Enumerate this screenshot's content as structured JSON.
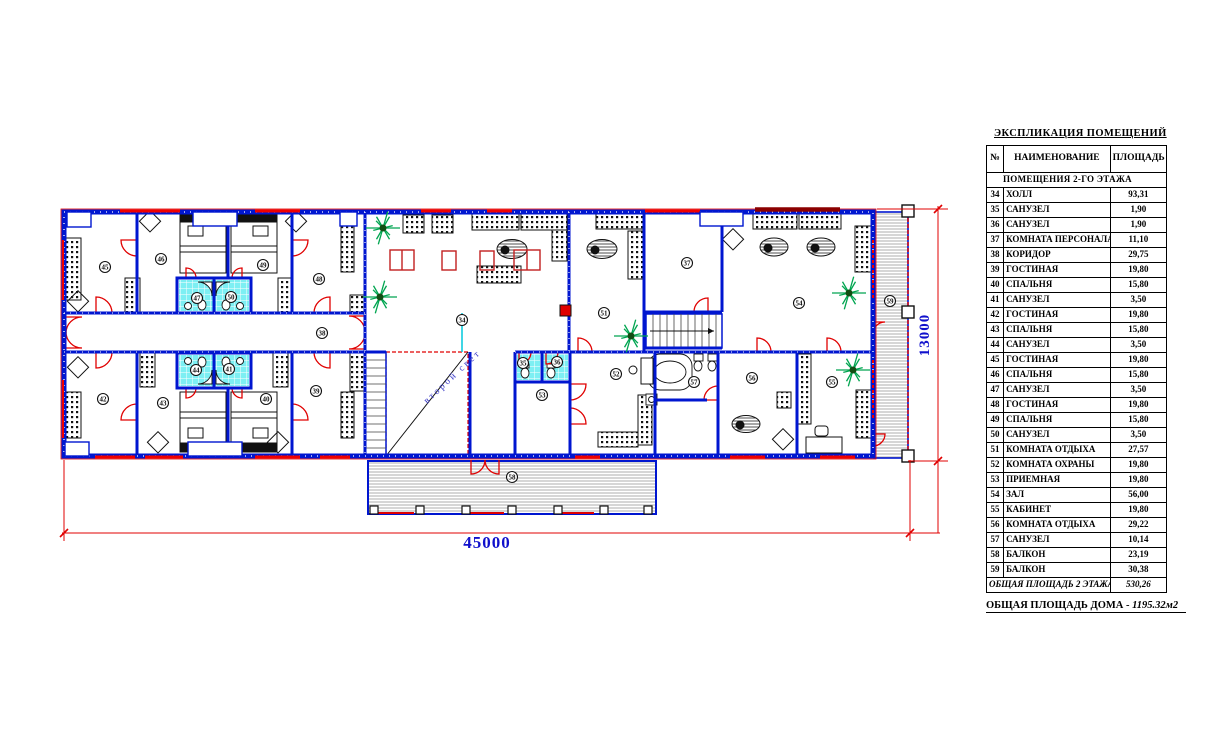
{
  "schedule": {
    "title": "ЭКСПЛИКАЦИЯ ПОМЕЩЕНИЙ",
    "columns": {
      "num": "№",
      "name": "НАИМЕНОВАНИЕ",
      "area": "ПЛОЩАДЬ"
    },
    "section": "ПОМЕЩЕНИЯ 2-ГО ЭТАЖА",
    "rows": [
      {
        "num": "34",
        "name": "ХОЛЛ",
        "area": "93,31"
      },
      {
        "num": "35",
        "name": "САНУЗЕЛ",
        "area": "1,90"
      },
      {
        "num": "36",
        "name": "САНУЗЕЛ",
        "area": "1,90"
      },
      {
        "num": "37",
        "name": "КОМНАТА ПЕРСОНАЛА",
        "area": "11,10"
      },
      {
        "num": "38",
        "name": "КОРИДОР",
        "area": "29,75"
      },
      {
        "num": "39",
        "name": "ГОСТИНАЯ",
        "area": "19,80"
      },
      {
        "num": "40",
        "name": "СПАЛЬНЯ",
        "area": "15,80"
      },
      {
        "num": "41",
        "name": "САНУЗЕЛ",
        "area": "3,50"
      },
      {
        "num": "42",
        "name": "ГОСТИНАЯ",
        "area": "19,80"
      },
      {
        "num": "43",
        "name": "СПАЛЬНЯ",
        "area": "15,80"
      },
      {
        "num": "44",
        "name": "САНУЗЕЛ",
        "area": "3,50"
      },
      {
        "num": "45",
        "name": "ГОСТИНАЯ",
        "area": "19,80"
      },
      {
        "num": "46",
        "name": "СПАЛЬНЯ",
        "area": "15,80"
      },
      {
        "num": "47",
        "name": "САНУЗЕЛ",
        "area": "3,50"
      },
      {
        "num": "48",
        "name": "ГОСТИНАЯ",
        "area": "19,80"
      },
      {
        "num": "49",
        "name": "СПАЛЬНЯ",
        "area": "15,80"
      },
      {
        "num": "50",
        "name": "САНУЗЕЛ",
        "area": "3,50"
      },
      {
        "num": "51",
        "name": "КОМНАТА ОТДЫХА",
        "area": "27,57"
      },
      {
        "num": "52",
        "name": "КОМНАТА ОХРАНЫ",
        "area": "19,80"
      },
      {
        "num": "53",
        "name": "ПРИЕМНАЯ",
        "area": "19,80"
      },
      {
        "num": "54",
        "name": "ЗАЛ",
        "area": "56,00"
      },
      {
        "num": "55",
        "name": "КАБИНЕТ",
        "area": "19,80"
      },
      {
        "num": "56",
        "name": "КОМНАТА ОТДЫХА",
        "area": "29,22"
      },
      {
        "num": "57",
        "name": "САНУЗЕЛ",
        "area": "10,14"
      },
      {
        "num": "58",
        "name": "БАЛКОН",
        "area": "23,19"
      },
      {
        "num": "59",
        "name": "БАЛКОН",
        "area": "30,38"
      }
    ],
    "total_label": "ОБЩАЯ ПЛОЩАДЬ 2 ЭТАЖА",
    "total_value": "530,26",
    "note_label": "ОБЩАЯ ПЛОЩАДЬ ДОМА -",
    "note_value": "1195.32м2"
  },
  "plan": {
    "dim_width_label": "45000",
    "dim_height_label": "13000",
    "void_label": "второй свет",
    "room_markers": [
      {
        "n": "34",
        "x": 462,
        "y": 320
      },
      {
        "n": "35",
        "x": 523,
        "y": 363
      },
      {
        "n": "36",
        "x": 557,
        "y": 362
      },
      {
        "n": "37",
        "x": 687,
        "y": 263
      },
      {
        "n": "38",
        "x": 322,
        "y": 333
      },
      {
        "n": "39",
        "x": 316,
        "y": 391
      },
      {
        "n": "40",
        "x": 266,
        "y": 399
      },
      {
        "n": "41",
        "x": 229,
        "y": 369
      },
      {
        "n": "42",
        "x": 103,
        "y": 399
      },
      {
        "n": "43",
        "x": 163,
        "y": 403
      },
      {
        "n": "44",
        "x": 196,
        "y": 370
      },
      {
        "n": "45",
        "x": 105,
        "y": 267
      },
      {
        "n": "46",
        "x": 161,
        "y": 259
      },
      {
        "n": "47",
        "x": 197,
        "y": 298
      },
      {
        "n": "48",
        "x": 319,
        "y": 279
      },
      {
        "n": "49",
        "x": 263,
        "y": 265
      },
      {
        "n": "50",
        "x": 231,
        "y": 297
      },
      {
        "n": "51",
        "x": 604,
        "y": 313
      },
      {
        "n": "52",
        "x": 616,
        "y": 374
      },
      {
        "n": "53",
        "x": 542,
        "y": 395
      },
      {
        "n": "54",
        "x": 799,
        "y": 303
      },
      {
        "n": "55",
        "x": 832,
        "y": 382
      },
      {
        "n": "56",
        "x": 752,
        "y": 378
      },
      {
        "n": "57",
        "x": 694,
        "y": 382
      },
      {
        "n": "58",
        "x": 512,
        "y": 477
      },
      {
        "n": "59",
        "x": 890,
        "y": 301
      }
    ],
    "plants": [
      {
        "x": 383,
        "y": 228
      },
      {
        "x": 380,
        "y": 297
      },
      {
        "x": 631,
        "y": 336
      },
      {
        "x": 849,
        "y": 293
      },
      {
        "x": 853,
        "y": 370
      }
    ],
    "colors": {
      "wall": "#0016d0",
      "window": "#f00000",
      "window_dark": "#8b0000",
      "tile": "#7deff3",
      "dim_line": "#e00000",
      "dim_text": "#1010cc",
      "plant": "#00a550",
      "void_text": "#3a3ac8",
      "furniture": "#111111",
      "table_red": "#c22020"
    }
  }
}
